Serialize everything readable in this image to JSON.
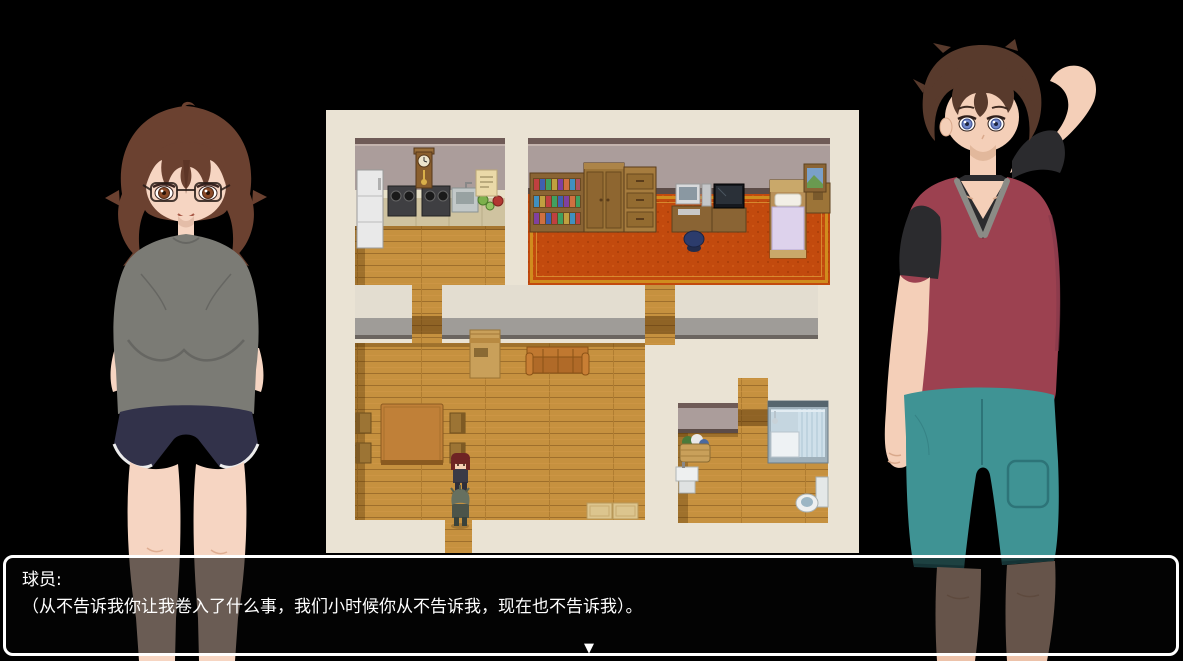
{
  "window": {
    "width": 1183,
    "height": 661,
    "background": "#000000"
  },
  "dialogue": {
    "speaker": "球员:",
    "line": "（从不告诉我你让我卷入了什么事，我们小时候你从不告诉我，现在也不告诉我）。",
    "continue_indicator": "▼",
    "border_color": "#ffffff",
    "text_color": "#ffffff"
  },
  "map": {
    "rooms": [
      "kitchen",
      "bedroom",
      "living-room",
      "bathroom"
    ],
    "sprites": [
      "player-sprite",
      "companion-sprite"
    ]
  },
  "palette": {
    "backdrop": "#eae3d4",
    "wood": "#c6913f",
    "wall": "#ab9d9b",
    "wall-trim": "#6f5b57",
    "wall-base": "#5c4c48",
    "hall-face": "#e3ddd0",
    "hall-base": "#9f9c98",
    "carpet": "#c24a0e",
    "carpet-border": "#d08c1e",
    "f-hair": "#6b4130",
    "f-skin": "#f6d5c2",
    "f-shirt": "#7b7b75",
    "f-shorts": "#32324a",
    "m-hair": "#583a2c",
    "m-skin": "#f4cfb8",
    "m-hoodie": "#9c4150",
    "m-under": "#2b2b2e",
    "m-shorts": "#3f9394"
  }
}
